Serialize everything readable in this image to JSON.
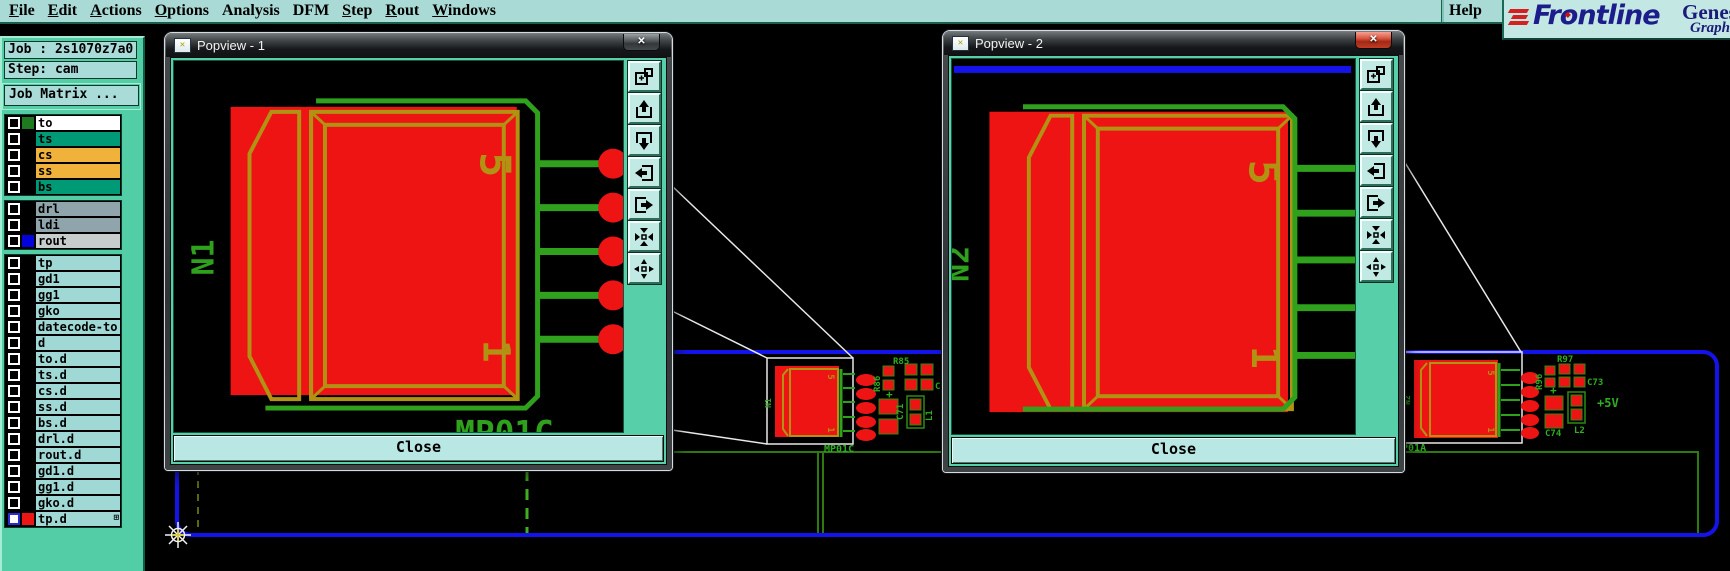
{
  "menu": {
    "items": [
      {
        "label": "File",
        "u": 0
      },
      {
        "label": "Edit",
        "u": 0
      },
      {
        "label": "Actions",
        "u": 0
      },
      {
        "label": "Options",
        "u": 0
      },
      {
        "label": "Analysis",
        "u": -1
      },
      {
        "label": "DFM",
        "u": -1
      },
      {
        "label": "Step",
        "u": 0
      },
      {
        "label": "Rout",
        "u": 0
      },
      {
        "label": "Windows",
        "u": 0
      }
    ],
    "help_label": "Help"
  },
  "brand": {
    "wordmark_fr": "Fr",
    "wordmark_o": "o",
    "wordmark_ntline": "ntline",
    "product_line1": "Genes",
    "product_line2": "Graph"
  },
  "sidebar": {
    "job_field": "Job : 2s1070z7a0",
    "step_field": "Step: cam",
    "matrix_button": "Job Matrix ...",
    "groups": [
      {
        "rows": [
          {
            "name": "to",
            "bg": "#ffffff",
            "swatch": "#1e7a1e"
          },
          {
            "name": "ts",
            "bg": "#019a77"
          },
          {
            "name": "cs",
            "bg": "#f0b23a"
          },
          {
            "name": "ss",
            "bg": "#f0b23a"
          },
          {
            "name": "bs",
            "bg": "#019a77"
          }
        ]
      },
      {
        "rows": [
          {
            "name": "drl",
            "bg": "#90a4ac"
          },
          {
            "name": "ldi",
            "bg": "#90a4ac"
          },
          {
            "name": "rout",
            "bg": "#c7cdcd",
            "swatch": "#0202dd"
          }
        ]
      },
      {
        "rows": [
          {
            "name": "tp",
            "bg": "#9fd8d4"
          },
          {
            "name": "gd1",
            "bg": "#9fd8d4"
          },
          {
            "name": "gg1",
            "bg": "#9fd8d4"
          },
          {
            "name": "gko",
            "bg": "#9fd8d4"
          },
          {
            "name": "datecode-to",
            "bg": "#9fd8d4"
          },
          {
            "name": "d",
            "bg": "#9fd8d4"
          },
          {
            "name": "to.d",
            "bg": "#9fd8d4"
          },
          {
            "name": "ts.d",
            "bg": "#9fd8d4"
          },
          {
            "name": "cs.d",
            "bg": "#9fd8d4"
          },
          {
            "name": "ss.d",
            "bg": "#9fd8d4"
          },
          {
            "name": "bs.d",
            "bg": "#9fd8d4"
          },
          {
            "name": "drl.d",
            "bg": "#9fd8d4"
          },
          {
            "name": "rout.d",
            "bg": "#9fd8d4"
          },
          {
            "name": "gd1.d",
            "bg": "#9fd8d4"
          },
          {
            "name": "gg1.d",
            "bg": "#9fd8d4"
          },
          {
            "name": "gko.d",
            "bg": "#9fd8d4"
          },
          {
            "name": "tp.d",
            "bg": "#9fd8d4",
            "swatch": "#ee1515",
            "selected": true,
            "grid_icon": true
          }
        ]
      }
    ]
  },
  "popview_toolbar": [
    "new-view-icon",
    "pan-up-icon",
    "pan-down-icon",
    "pan-left-icon",
    "pan-right-icon",
    "arrows-in-icon",
    "arrows-out-icon"
  ],
  "popviews": [
    {
      "title": "Popview - 1",
      "close_label": "Close",
      "refdes": "N1",
      "pin_high": "5",
      "pin_low": "1",
      "footprint_label": "MP01C"
    },
    {
      "title": "Popview - 2",
      "close_label": "Close",
      "refdes": "N2",
      "pin_high": "5",
      "pin_low": "1"
    }
  ],
  "board": {
    "left_module": {
      "name": "MP01C",
      "refdes": "N1",
      "pin_high": "5",
      "pin_low": "1",
      "r1": "R85",
      "r2": "R86",
      "c1": "C72",
      "cap": "C71",
      "ind": "L1",
      "plus": "+"
    },
    "right_module": {
      "name": "MP01A",
      "refdes": "N2",
      "pin_high": "5",
      "pin_low": "1",
      "r1": "R97",
      "r2": "R96",
      "c1": "C73",
      "cap": "C74",
      "ind": "L2",
      "plus": "+",
      "net_label": "+5V"
    }
  },
  "colors": {
    "desktop_teal": "#53cda6",
    "panel_cyan": "#a9dcd8",
    "canvas_black": "#000000",
    "copper_red": "#ee1414",
    "silkscreen_green": "#2fa11d",
    "package_olive": "#b29212",
    "board_outline_blue": "#1414ea",
    "logo_navy": "#1c1c8a",
    "logo_red": "#d81f1f"
  }
}
